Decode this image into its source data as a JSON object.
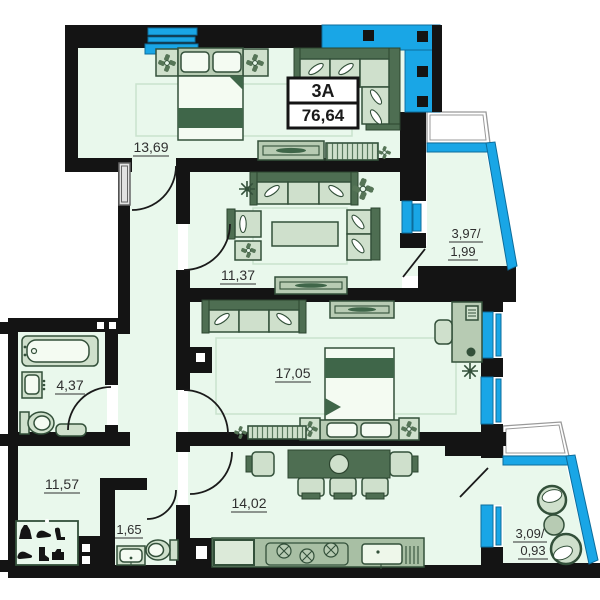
{
  "plan": {
    "unit": {
      "name": "3A",
      "total_area": "76,64"
    },
    "rooms": {
      "bedroom1": {
        "label": "13,69"
      },
      "living": {
        "label": "11,37"
      },
      "bedroom2": {
        "label": "17,05"
      },
      "bathroom": {
        "label": "4,37"
      },
      "hallway": {
        "label": "11,57"
      },
      "wc": {
        "label": "1,65"
      },
      "kitchen": {
        "label": "14,02"
      },
      "loggia": {
        "label_full": "3,97/",
        "label_half": "1,99"
      },
      "balcony": {
        "label_full": "3,09/",
        "label_half": "0,93"
      }
    },
    "colors": {
      "wall": "#141414",
      "floor": "#e9f8ec",
      "glazing_blue": "#19a6e6",
      "furniture_light": "#cfe0cc",
      "furniture_dark": "#4e6e52",
      "outline": "#33503a"
    },
    "closet_icons": [
      "dress",
      "shoe",
      "heel",
      "sneaker",
      "boot",
      "bag"
    ]
  }
}
